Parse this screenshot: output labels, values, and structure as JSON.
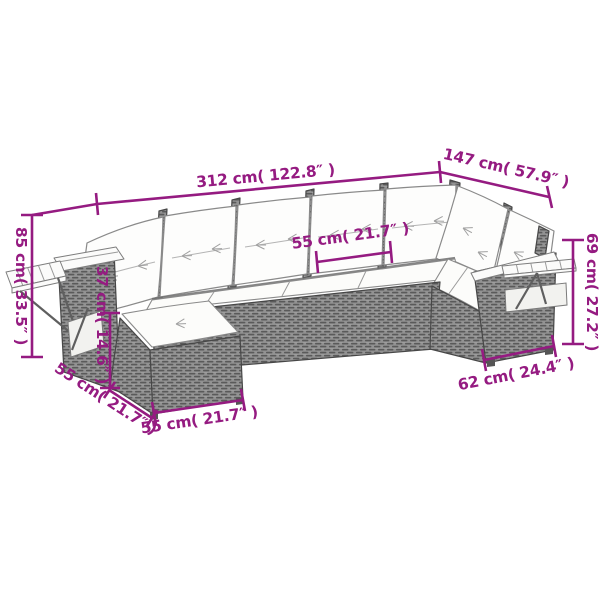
{
  "colors": {
    "dimension_accent": "#951b81",
    "wicker_dark": "#5a5a5a",
    "wicker_mid": "#929292",
    "outline_gray": "#474747",
    "cushion_white": "#fdfdfc",
    "background": "#ffffff"
  },
  "dimension_labels": {
    "total_length": "312 cm( 122.8″ )",
    "return_length": "147 cm( 57.9″ )",
    "overall_height": "85 cm( 33.5″ )",
    "seat_height": "37 cm( 14.6″ )",
    "footstool_side_width": "55 cm( 21.7″ )",
    "footstool_front_width": "55 cm( 21.7″ )",
    "seat_width": "55 cm( 21.7″ )",
    "armrest_section_width": "62 cm( 24.4″ )",
    "backrest_height": "69 cm( 27.2″ )"
  }
}
